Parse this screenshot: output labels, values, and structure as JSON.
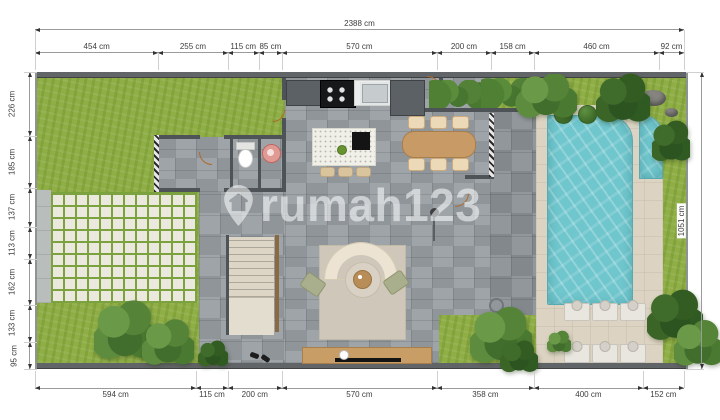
{
  "watermark": {
    "text": "rumah123",
    "icon": "house-location-pin"
  },
  "dimensions": {
    "unit": "cm",
    "top_total": {
      "label": "2388 cm",
      "value": 2388
    },
    "right_total": {
      "label": "1051 cm",
      "value": 1051
    },
    "top": [
      {
        "label": "454 cm",
        "value": 454
      },
      {
        "label": "255 cm",
        "value": 255
      },
      {
        "label": "115 cm",
        "value": 115
      },
      {
        "label": "85 cm",
        "value": 85
      },
      {
        "label": "570 cm",
        "value": 570
      },
      {
        "label": "200 cm",
        "value": 200
      },
      {
        "label": "158 cm",
        "value": 158
      },
      {
        "label": "460 cm",
        "value": 460
      },
      {
        "label": "92 cm",
        "value": 92
      }
    ],
    "bottom": [
      {
        "label": "594 cm",
        "value": 594
      },
      {
        "label": "115 cm",
        "value": 115
      },
      {
        "label": "200 cm",
        "value": 200
      },
      {
        "label": "570 cm",
        "value": 570
      },
      {
        "label": "358 cm",
        "value": 358
      },
      {
        "label": "400 cm",
        "value": 400
      },
      {
        "label": "152 cm",
        "value": 152
      }
    ],
    "left": [
      {
        "label": "226 cm",
        "value": 226
      },
      {
        "label": "185 cm",
        "value": 185
      },
      {
        "label": "137 cm",
        "value": 137
      },
      {
        "label": "113 cm",
        "value": 113
      },
      {
        "label": "162 cm",
        "value": 162
      },
      {
        "label": "133 cm",
        "value": 133
      },
      {
        "label": "95 cm",
        "value": 95
      }
    ]
  },
  "colors": {
    "grass": "#8fae45",
    "tile_floor": "#989ea3",
    "pool_water": "#6fc6cd",
    "pool_deck": "#dcd3c2",
    "wall": "#4e5357",
    "wood": "#c79a66",
    "paver": "#ebe9dd",
    "watermark": "#ffffff"
  }
}
